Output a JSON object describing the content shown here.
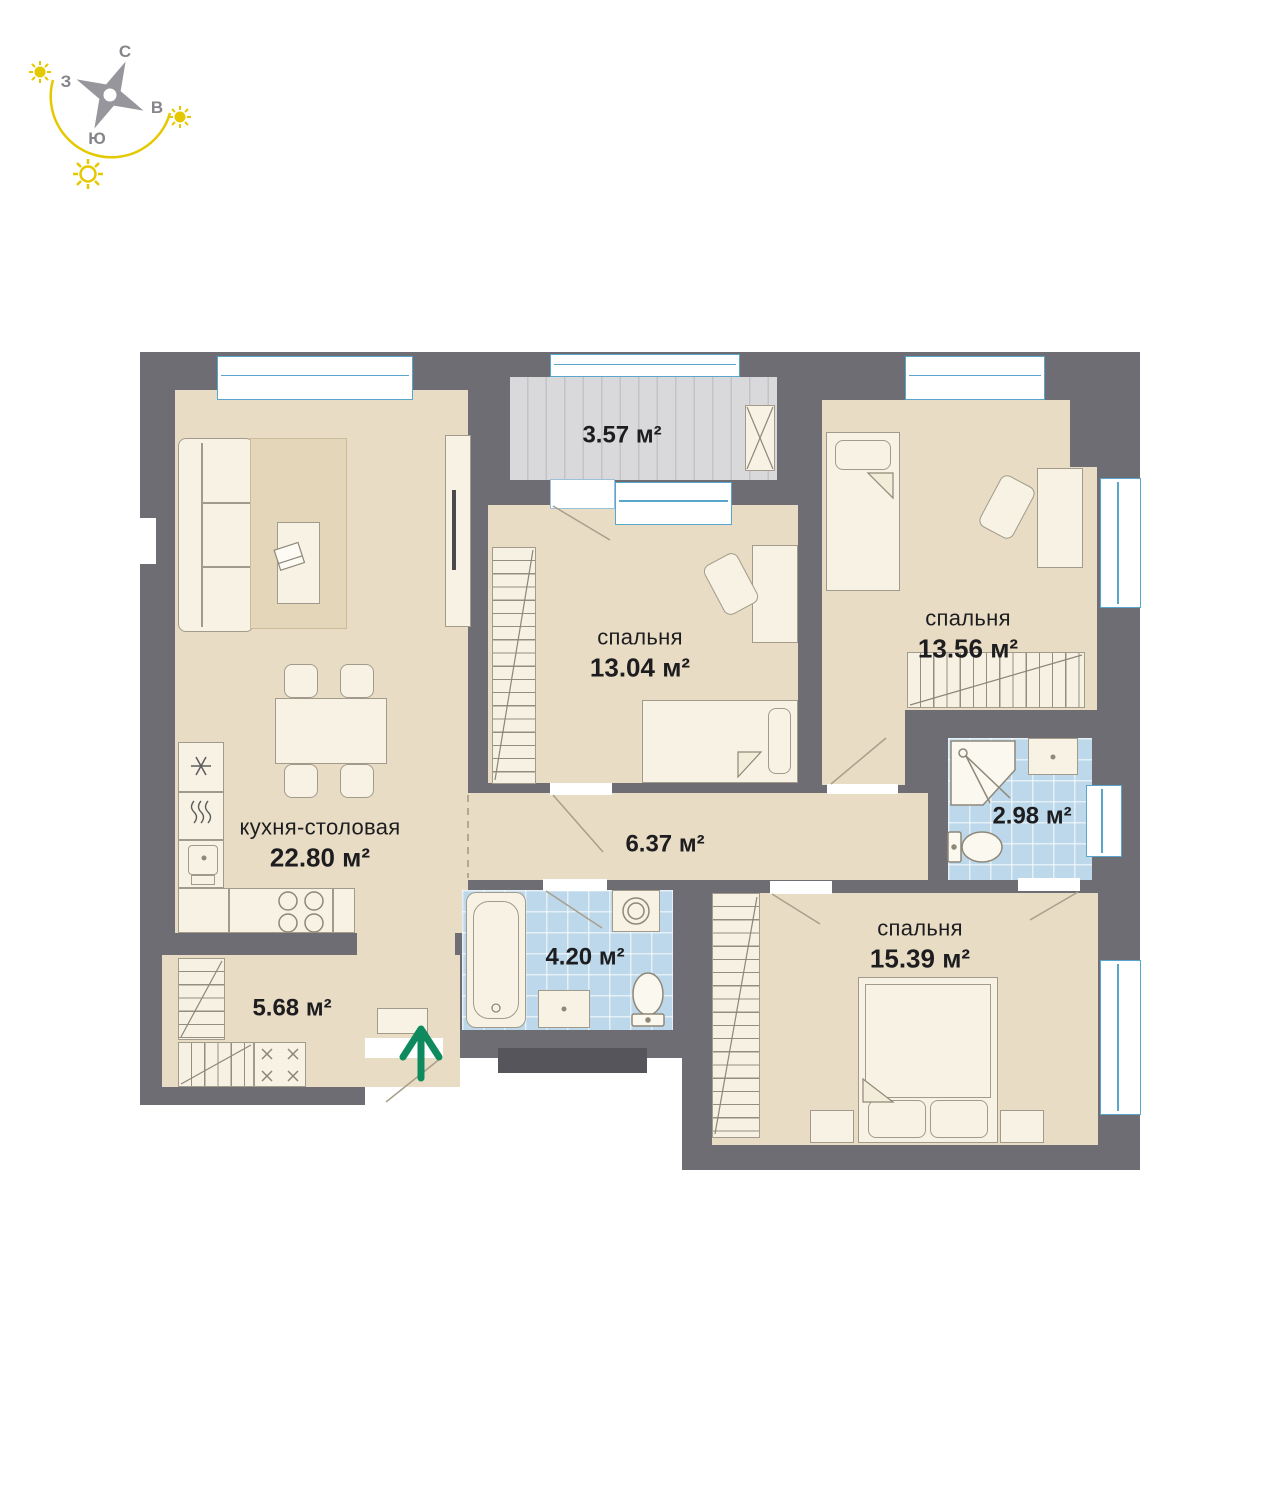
{
  "compass": {
    "north": "С",
    "east": "В",
    "south": "Ю",
    "west": "З"
  },
  "rooms": {
    "kitchen": {
      "name": "кухня-столовая",
      "area": "22.80 м²"
    },
    "bedroom1": {
      "name": "спальня",
      "area": "13.04 м²"
    },
    "bedroom2": {
      "name": "спальня",
      "area": "13.56 м²"
    },
    "bedroom3": {
      "name": "спальня",
      "area": "15.39 м²"
    },
    "balcony": {
      "area": "3.57 м²"
    },
    "corridor": {
      "area": "6.37 м²"
    },
    "bathroom_small": {
      "area": "2.98 м²"
    },
    "bathroom_main": {
      "area": "4.20 м²"
    },
    "entry_hall": {
      "area": "5.68 м²"
    }
  },
  "icons": {
    "entry_arrow": "entrance-arrow",
    "compass": "compass-rose",
    "suns": "sun-icon"
  },
  "colors": {
    "wall": "#6e6d73",
    "floor": "#e8dcc5",
    "bath_tile": "#bcd8ea",
    "balcony_floor": "#d9d9dc",
    "window": "#58a6cb",
    "entry_arrow": "#0f8a5f",
    "sun": "#e5c900",
    "text": "#1d1d1f"
  }
}
